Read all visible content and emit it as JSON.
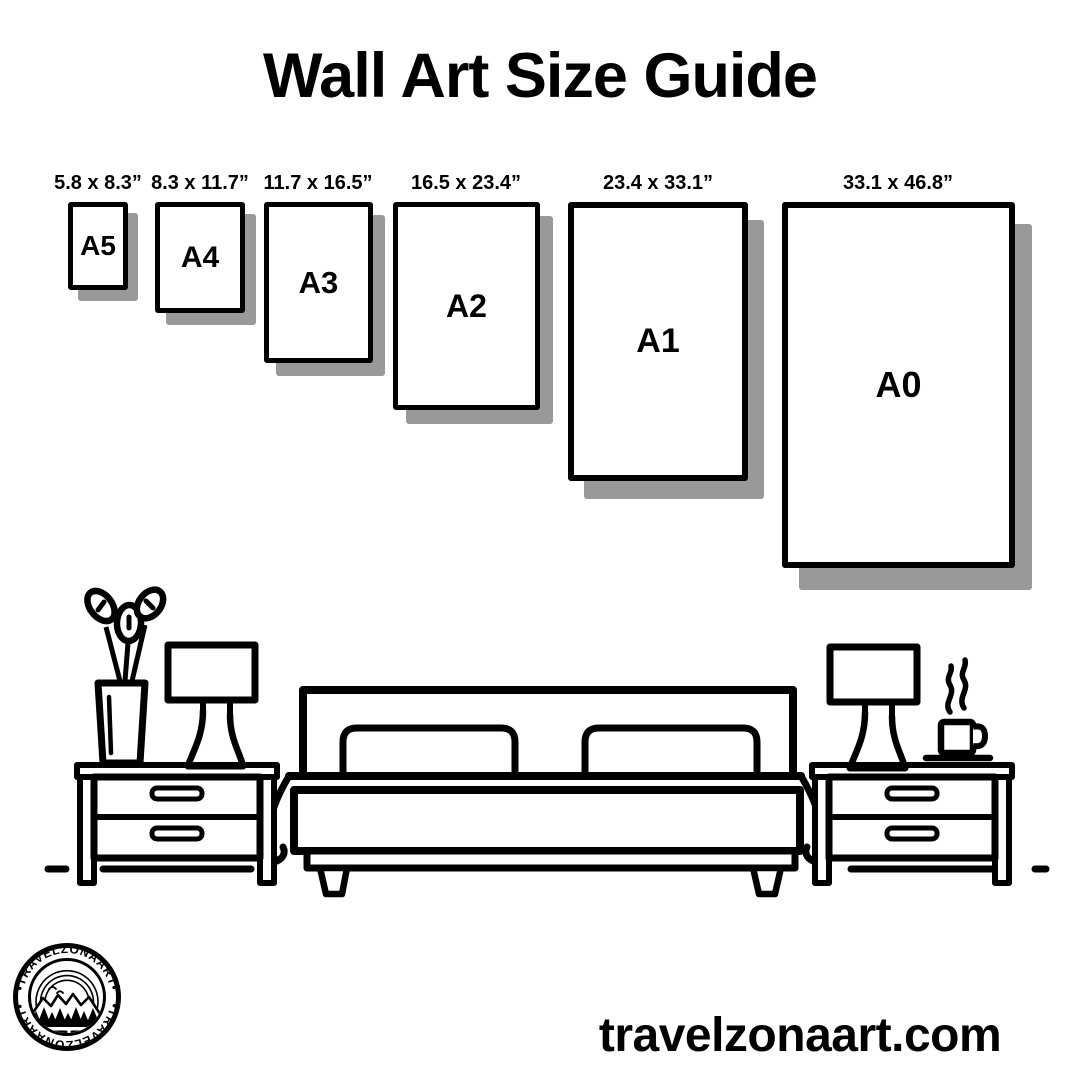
{
  "title": "Wall Art Size Guide",
  "sizes": [
    {
      "name": "A5",
      "dimensions": "5.8 x 8.3”"
    },
    {
      "name": "A4",
      "dimensions": "8.3 x 11.7”"
    },
    {
      "name": "A3",
      "dimensions": "11.7 x 16.5”"
    },
    {
      "name": "A2",
      "dimensions": "16.5 x 23.4”"
    },
    {
      "name": "A1",
      "dimensions": "23.4 x 33.1”"
    },
    {
      "name": "A0",
      "dimensions": "33.1 x 46.8”"
    }
  ],
  "logo": {
    "brand": "TRAVELZONAART",
    "arc_text_top": "•TRAVELZONAART•",
    "arc_text_bottom": "•TRAVELZONAART•"
  },
  "footer": {
    "website": "travelzonaart.com"
  },
  "colors": {
    "ink": "#000000",
    "shadow": "#999999",
    "background": "#ffffff"
  },
  "illustration": {
    "icons": [
      "potted-plant-icon",
      "table-lamp-icon",
      "nightstand-icon",
      "double-bed-icon",
      "pillow-icon",
      "coffee-cup-icon",
      "steam-icon",
      "floor-line",
      "moon-icon",
      "mountains-icon",
      "pine-trees-icon"
    ]
  }
}
